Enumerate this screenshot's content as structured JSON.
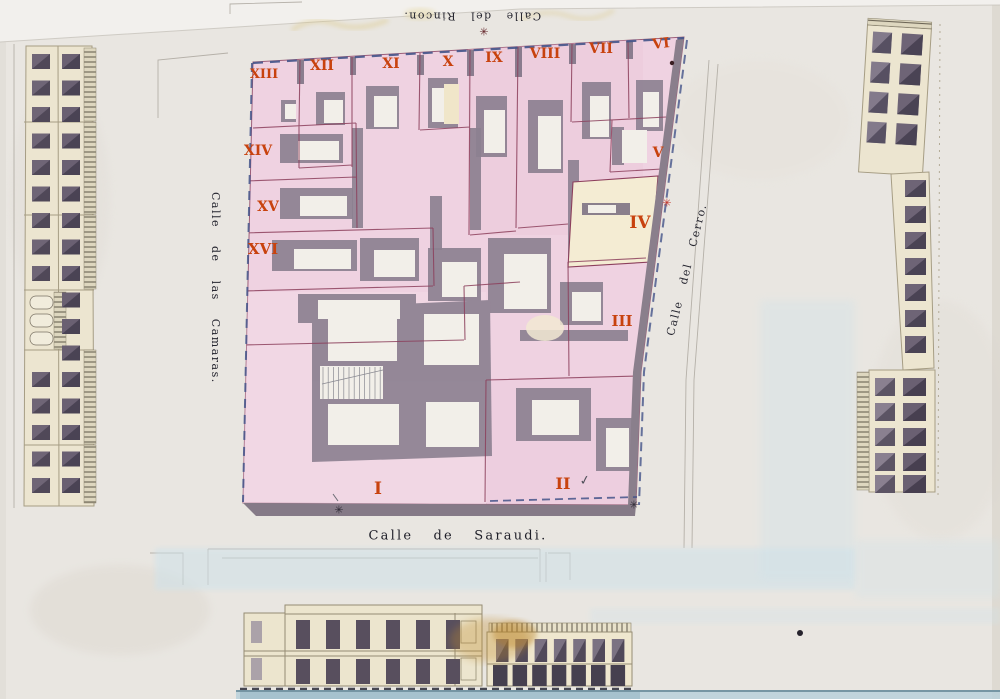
{
  "streets": {
    "top": "Calle del Rincon.",
    "left": "Calle de las Camaras.",
    "right": "Calle del Cerro.",
    "bottom": "Calle de Saraudi."
  },
  "lots": {
    "i": "I",
    "ii": "II",
    "iii": "III",
    "iv": "IV",
    "v": "V",
    "vi": "VI",
    "vii": "VII",
    "viii": "VIII",
    "ix": "IX",
    "x": "X",
    "xi": "XI",
    "xii": "XII",
    "xiii": "XIII",
    "xiv": "XIV",
    "xv": "XV",
    "xvi": "XVI"
  },
  "marks": {
    "star": "✳",
    "check": "✓"
  },
  "colors": {
    "paper": "#e9e6e1",
    "lot_pink": "#efd2e1",
    "lot_beige": "#f4ecd3",
    "shadow_gray": "#8d8191",
    "numeral_red": "#c8420e",
    "dash_blue": "#44548a",
    "wash_blue": "#cfe2ea",
    "wall_cream": "#ece5d0",
    "window_dark": "#574f5d"
  }
}
